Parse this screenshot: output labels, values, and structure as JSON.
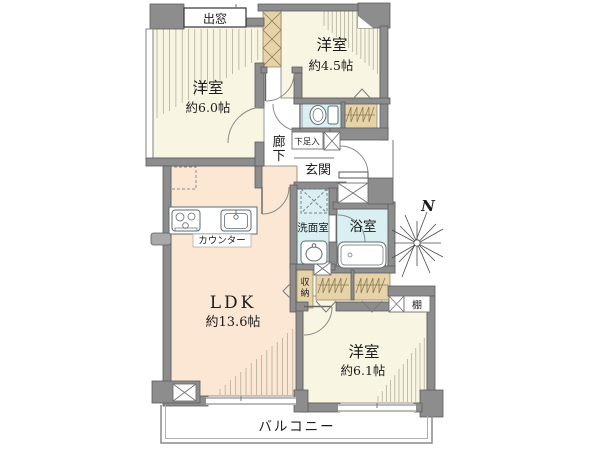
{
  "floorplan": {
    "labels": {
      "bay_window": "出窓",
      "room_nw_name": "洋室",
      "room_nw_size": "約6.0帖",
      "room_ne_name": "洋室",
      "room_ne_size": "約4.5帖",
      "hallway_char1": "廊",
      "hallway_char2": "下",
      "shoe_cabinet": "下足入",
      "entrance": "玄関",
      "washroom": "洗面室",
      "bathroom": "浴室",
      "storage_char1": "収",
      "storage_char2": "納",
      "kitchen_counter": "カウンター",
      "ldk_name": "LDK",
      "ldk_size": "約13.6帖",
      "shelf": "棚",
      "room_se_name": "洋室",
      "room_se_size": "約6.1帖",
      "balcony": "バルコニー",
      "compass_north": "N"
    },
    "colors": {
      "wall": "#8d8d8d",
      "western_room_floor": "#f8f5e2",
      "ldk_floor": "#fbe7d3",
      "wet_area_floor": "#d9eff1",
      "closet": "#e6d3aa",
      "background": "#ffffff"
    }
  }
}
